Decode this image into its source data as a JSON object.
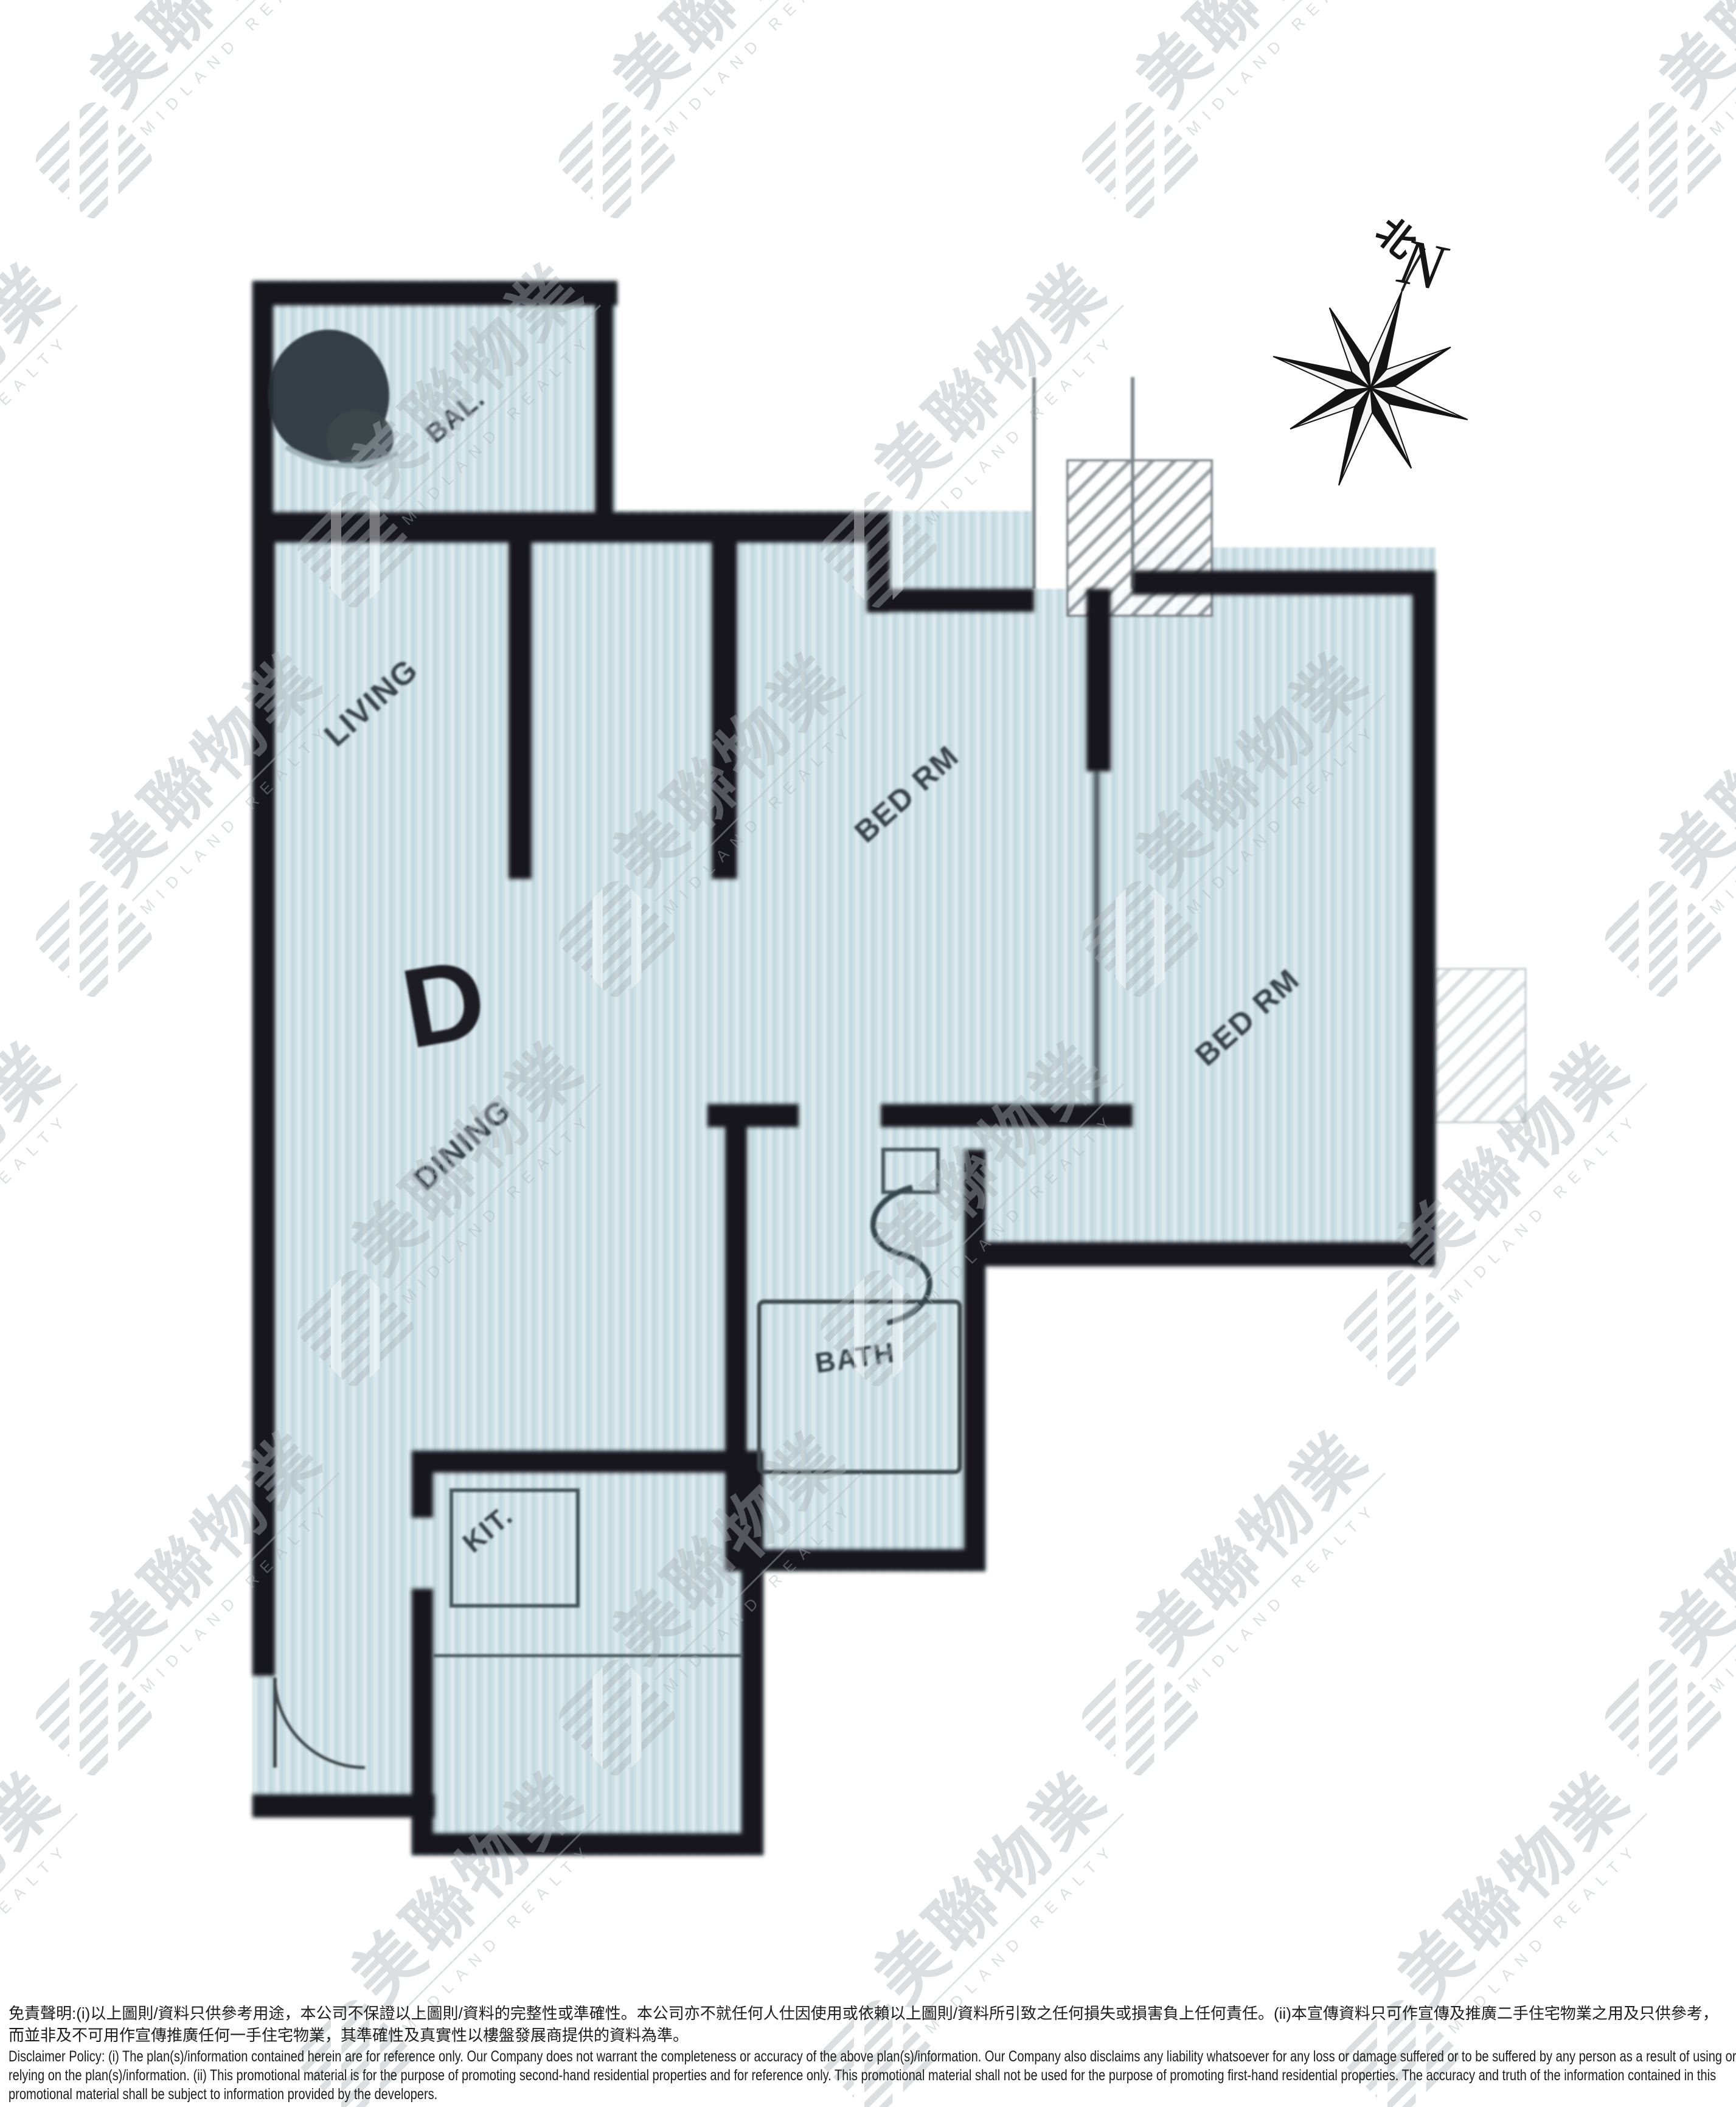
{
  "floorplan": {
    "unit_label": "D",
    "rooms": {
      "balcony": "BAL.",
      "living": "LIVING",
      "dining": "DINING",
      "bedroom1": "BED RM",
      "bedroom2": "BED RM",
      "bath": "BATH",
      "kitchen": "KIT."
    },
    "compass": {
      "north_cn": "北",
      "north_en": "N"
    }
  },
  "watermark": {
    "cn": "美聯物業",
    "en": "MIDLAND REALTY"
  },
  "disclaimer": {
    "zh": "免責聲明:(i)以上圖則/資料只供參考用途，本公司不保證以上圖則/資料的完整性或準確性。本公司亦不就任何人仕因使用或依賴以上圖則/資料所引致之任何損失或損害負上任何責任。(ii)本宣傳資料只可作宣傳及推廣二手住宅物業之用及只供參考， 而並非及不可用作宣傳推廣任何一手住宅物業，其準確性及真實性以樓盤發展商提供的資料為準。",
    "en": "Disclaimer Policy: (i) The plan(s)/information contained herein are for reference only. Our Company does not warrant the completeness or accuracy of the above plan(s)/information. Our Company also disclaims any liability whatsoever for any loss or damage suffered or to be suffered by any person as a result of using or relying on the plan(s)/information. (ii) This promotional material is for the purpose of promoting second-hand residential properties and for reference only. This promotional material shall not be used for the purpose of promoting first-hand residential properties. The accuracy and truth of the information contained in this promotional material shall be subject to information provided by the developers."
  },
  "colors": {
    "plan_fill": "#cde0e6",
    "wall": "#15191d",
    "watermark": "#a9b3b8",
    "background": "#ffffff"
  }
}
